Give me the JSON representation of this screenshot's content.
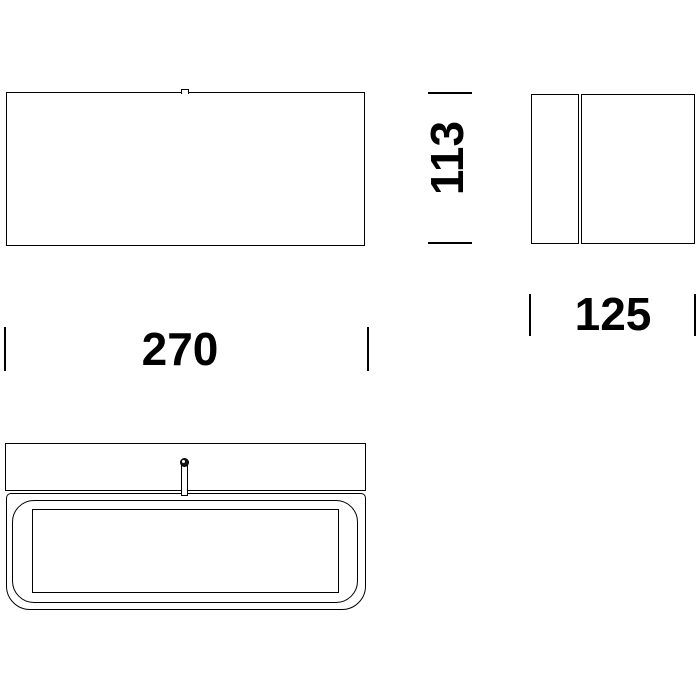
{
  "meta": {
    "background_color": "#ffffff",
    "line_color": "#000000",
    "text_color": "#000000"
  },
  "drawing": {
    "kind": "technical dimension drawing, three orthographic views of a wall lamp",
    "views": {
      "front": "front view with small top cable notch",
      "side": "side view with mounting plate and body",
      "bottom": "bottom view with rounded diffuser frame and set screw"
    },
    "dimensions": {
      "width": "270",
      "height": "113",
      "depth": "125"
    }
  }
}
